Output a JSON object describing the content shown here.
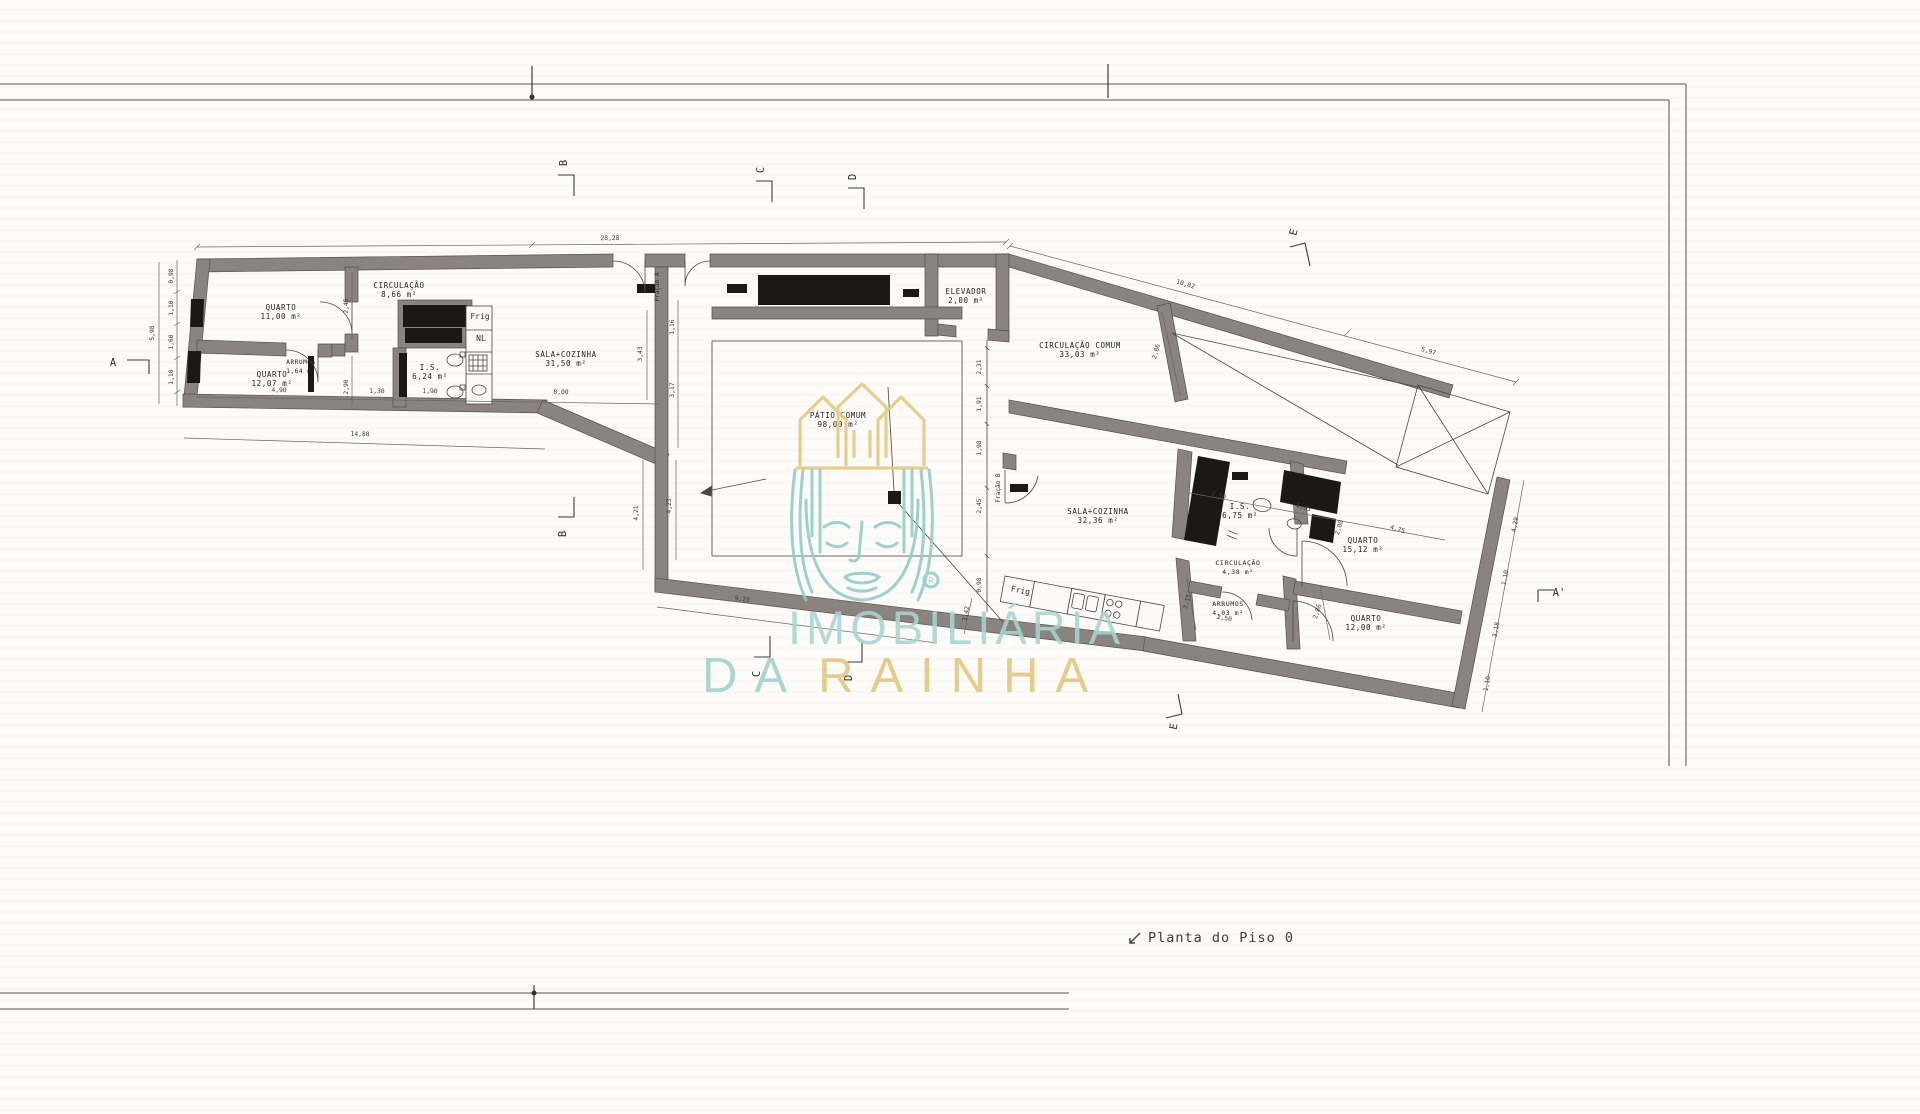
{
  "title": {
    "text": "Planta do Piso 0"
  },
  "watermark": {
    "line1": "IMOBILIÁRIA",
    "line2_da": "DA",
    "line2_rainha": "RAINHA",
    "reg": "®",
    "teal": "#8fccc8",
    "teal_light": "#a7d5d1",
    "gold": "#e4c57c"
  },
  "colors": {
    "wall": "#8b837e",
    "wall_edge": "#57504b",
    "dark_fill": "#1c1815",
    "thin_line": "#4a4743",
    "dim_line": "#6a665f",
    "text": "#222222",
    "frame": "#7a7672"
  },
  "plan": {
    "rooms": [
      {
        "label": "QUARTO",
        "area": "11,00 m²",
        "x": 281,
        "y": 310
      },
      {
        "label": "QUARTO",
        "area": "12,07 m²",
        "x": 272,
        "y": 377
      },
      {
        "label": "CIRCULAÇÃO",
        "area": "8,66 m²",
        "x": 399,
        "y": 288
      },
      {
        "label": "ARRUMOS",
        "area": "1,64 m²",
        "x": 301,
        "y": 364,
        "size": 6
      },
      {
        "label": "I.S.",
        "area": "6,24 m²",
        "x": 430,
        "y": 370
      },
      {
        "label": "SALA+COZINHA",
        "area": "31,50 m²",
        "x": 566,
        "y": 357
      },
      {
        "label": "ELEVADOR",
        "area": "2,00 m²",
        "x": 966,
        "y": 294
      },
      {
        "label": "CIRCULAÇÃO COMUM",
        "area": "33,03 m²",
        "x": 1080,
        "y": 348
      },
      {
        "label": "PÁTIO COMUM",
        "area": "98,00 m²",
        "x": 838,
        "y": 418
      },
      {
        "label": "SALA+COZINHA",
        "area": "32,36 m²",
        "x": 1098,
        "y": 514
      },
      {
        "label": "I.S.",
        "area": "6,75 m²",
        "x": 1240,
        "y": 509
      },
      {
        "label": "CIRCULAÇÃO",
        "area": "4,38 m²",
        "x": 1238,
        "y": 565,
        "size": 6.5
      },
      {
        "label": "ARRUMOS",
        "area": "4,03 m²",
        "x": 1228,
        "y": 606,
        "size": 6.5
      },
      {
        "label": "QUARTO",
        "area": "15,12 m²",
        "x": 1363,
        "y": 543
      },
      {
        "label": "QUARTO",
        "area": "12,00 m²",
        "x": 1366,
        "y": 621
      }
    ],
    "fixtures": [
      {
        "t": "Frig",
        "x": 480,
        "y": 319,
        "r": 0,
        "size": 8
      },
      {
        "t": "NL",
        "x": 481,
        "y": 341,
        "r": 0,
        "size": 8
      },
      {
        "t": "Frig",
        "x": 1020,
        "y": 593,
        "r": 11,
        "size": 8
      },
      {
        "t": "Fração A",
        "x": 659,
        "y": 287,
        "r": -90,
        "size": 6
      },
      {
        "t": "Fração B",
        "x": 1000,
        "y": 488,
        "r": -90,
        "size": 6
      }
    ],
    "dims": [
      {
        "t": "28,28",
        "x": 610,
        "y": 240,
        "r": -0.5
      },
      {
        "t": "14,88",
        "x": 360,
        "y": 436,
        "r": 1.7
      },
      {
        "t": "9,29",
        "x": 742,
        "y": 601,
        "r": 7.3
      },
      {
        "t": "4,90",
        "x": 279,
        "y": 392,
        "r": 1
      },
      {
        "t": "1,30",
        "x": 377,
        "y": 393,
        "r": 1
      },
      {
        "t": "1,90",
        "x": 430,
        "y": 393,
        "r": 1
      },
      {
        "t": "8,00",
        "x": 561,
        "y": 394,
        "r": 1
      },
      {
        "t": "2,45",
        "x": 348,
        "y": 306,
        "r": -90
      },
      {
        "t": "2,90",
        "x": 348,
        "y": 387,
        "r": -90
      },
      {
        "t": "5,98",
        "x": 154,
        "y": 333,
        "r": -90
      },
      {
        "t": "0,98",
        "x": 173,
        "y": 276,
        "r": -90
      },
      {
        "t": "1,10",
        "x": 173,
        "y": 308,
        "r": -90
      },
      {
        "t": "1,60",
        "x": 173,
        "y": 342,
        "r": -90
      },
      {
        "t": "1,10",
        "x": 173,
        "y": 377,
        "r": -90
      },
      {
        "t": "3,43",
        "x": 642,
        "y": 354,
        "r": -90
      },
      {
        "t": "1,16",
        "x": 674,
        "y": 327,
        "r": -90
      },
      {
        "t": "3,17",
        "x": 674,
        "y": 390,
        "r": -90
      },
      {
        "t": "4,23",
        "x": 671,
        "y": 506,
        "r": -90
      },
      {
        "t": "4,21",
        "x": 638,
        "y": 513,
        "r": -90
      },
      {
        "t": "2,31",
        "x": 981,
        "y": 367,
        "r": -90
      },
      {
        "t": "1,91",
        "x": 981,
        "y": 404,
        "r": -90
      },
      {
        "t": "1,98",
        "x": 981,
        "y": 448,
        "r": -90
      },
      {
        "t": "2,45",
        "x": 981,
        "y": 506,
        "r": -90
      },
      {
        "t": "0,98",
        "x": 981,
        "y": 585,
        "r": -90
      },
      {
        "t": "10,82",
        "x": 1185,
        "y": 286,
        "r": 16.4
      },
      {
        "t": "5,97",
        "x": 1428,
        "y": 353,
        "r": 16.4
      },
      {
        "t": "2,86",
        "x": 1158,
        "y": 352,
        "r": -75
      },
      {
        "t": "3,50",
        "x": 1218,
        "y": 497,
        "r": 17
      },
      {
        "t": "1,85",
        "x": 1303,
        "y": 509,
        "r": 17
      },
      {
        "t": "2,80",
        "x": 1341,
        "y": 528,
        "r": -73
      },
      {
        "t": "4,75",
        "x": 1397,
        "y": 531,
        "r": 17
      },
      {
        "t": "2,86",
        "x": 1319,
        "y": 612,
        "r": -73
      },
      {
        "t": "3,15",
        "x": 1189,
        "y": 602,
        "r": -75
      },
      {
        "t": "2,50",
        "x": 1224,
        "y": 620,
        "r": 10
      },
      {
        "t": "3,42",
        "x": 968,
        "y": 614,
        "r": -80
      },
      {
        "t": "4,29",
        "x": 1517,
        "y": 525,
        "r": -80
      },
      {
        "t": "1,10",
        "x": 1507,
        "y": 578,
        "r": -80
      },
      {
        "t": "3,18",
        "x": 1498,
        "y": 630,
        "r": -80
      },
      {
        "t": "1,10",
        "x": 1489,
        "y": 684,
        "r": -80
      }
    ],
    "markers": [
      {
        "t": "A",
        "x": 113,
        "y": 366,
        "r": 0
      },
      {
        "t": "A'",
        "x": 1559,
        "y": 596,
        "r": 0
      },
      {
        "t": "B",
        "x": 567,
        "y": 163,
        "r": -90
      },
      {
        "t": "C",
        "x": 764,
        "y": 170,
        "r": -90
      },
      {
        "t": "D",
        "x": 856,
        "y": 177,
        "r": -90
      },
      {
        "t": "E",
        "x": 1297,
        "y": 233,
        "r": -75
      },
      {
        "t": "B",
        "x": 566,
        "y": 534,
        "r": -90
      },
      {
        "t": "C",
        "x": 760,
        "y": 674,
        "r": -90
      },
      {
        "t": "D",
        "x": 852,
        "y": 678,
        "r": -90
      },
      {
        "t": "E",
        "x": 1177,
        "y": 727,
        "r": -80
      }
    ]
  }
}
